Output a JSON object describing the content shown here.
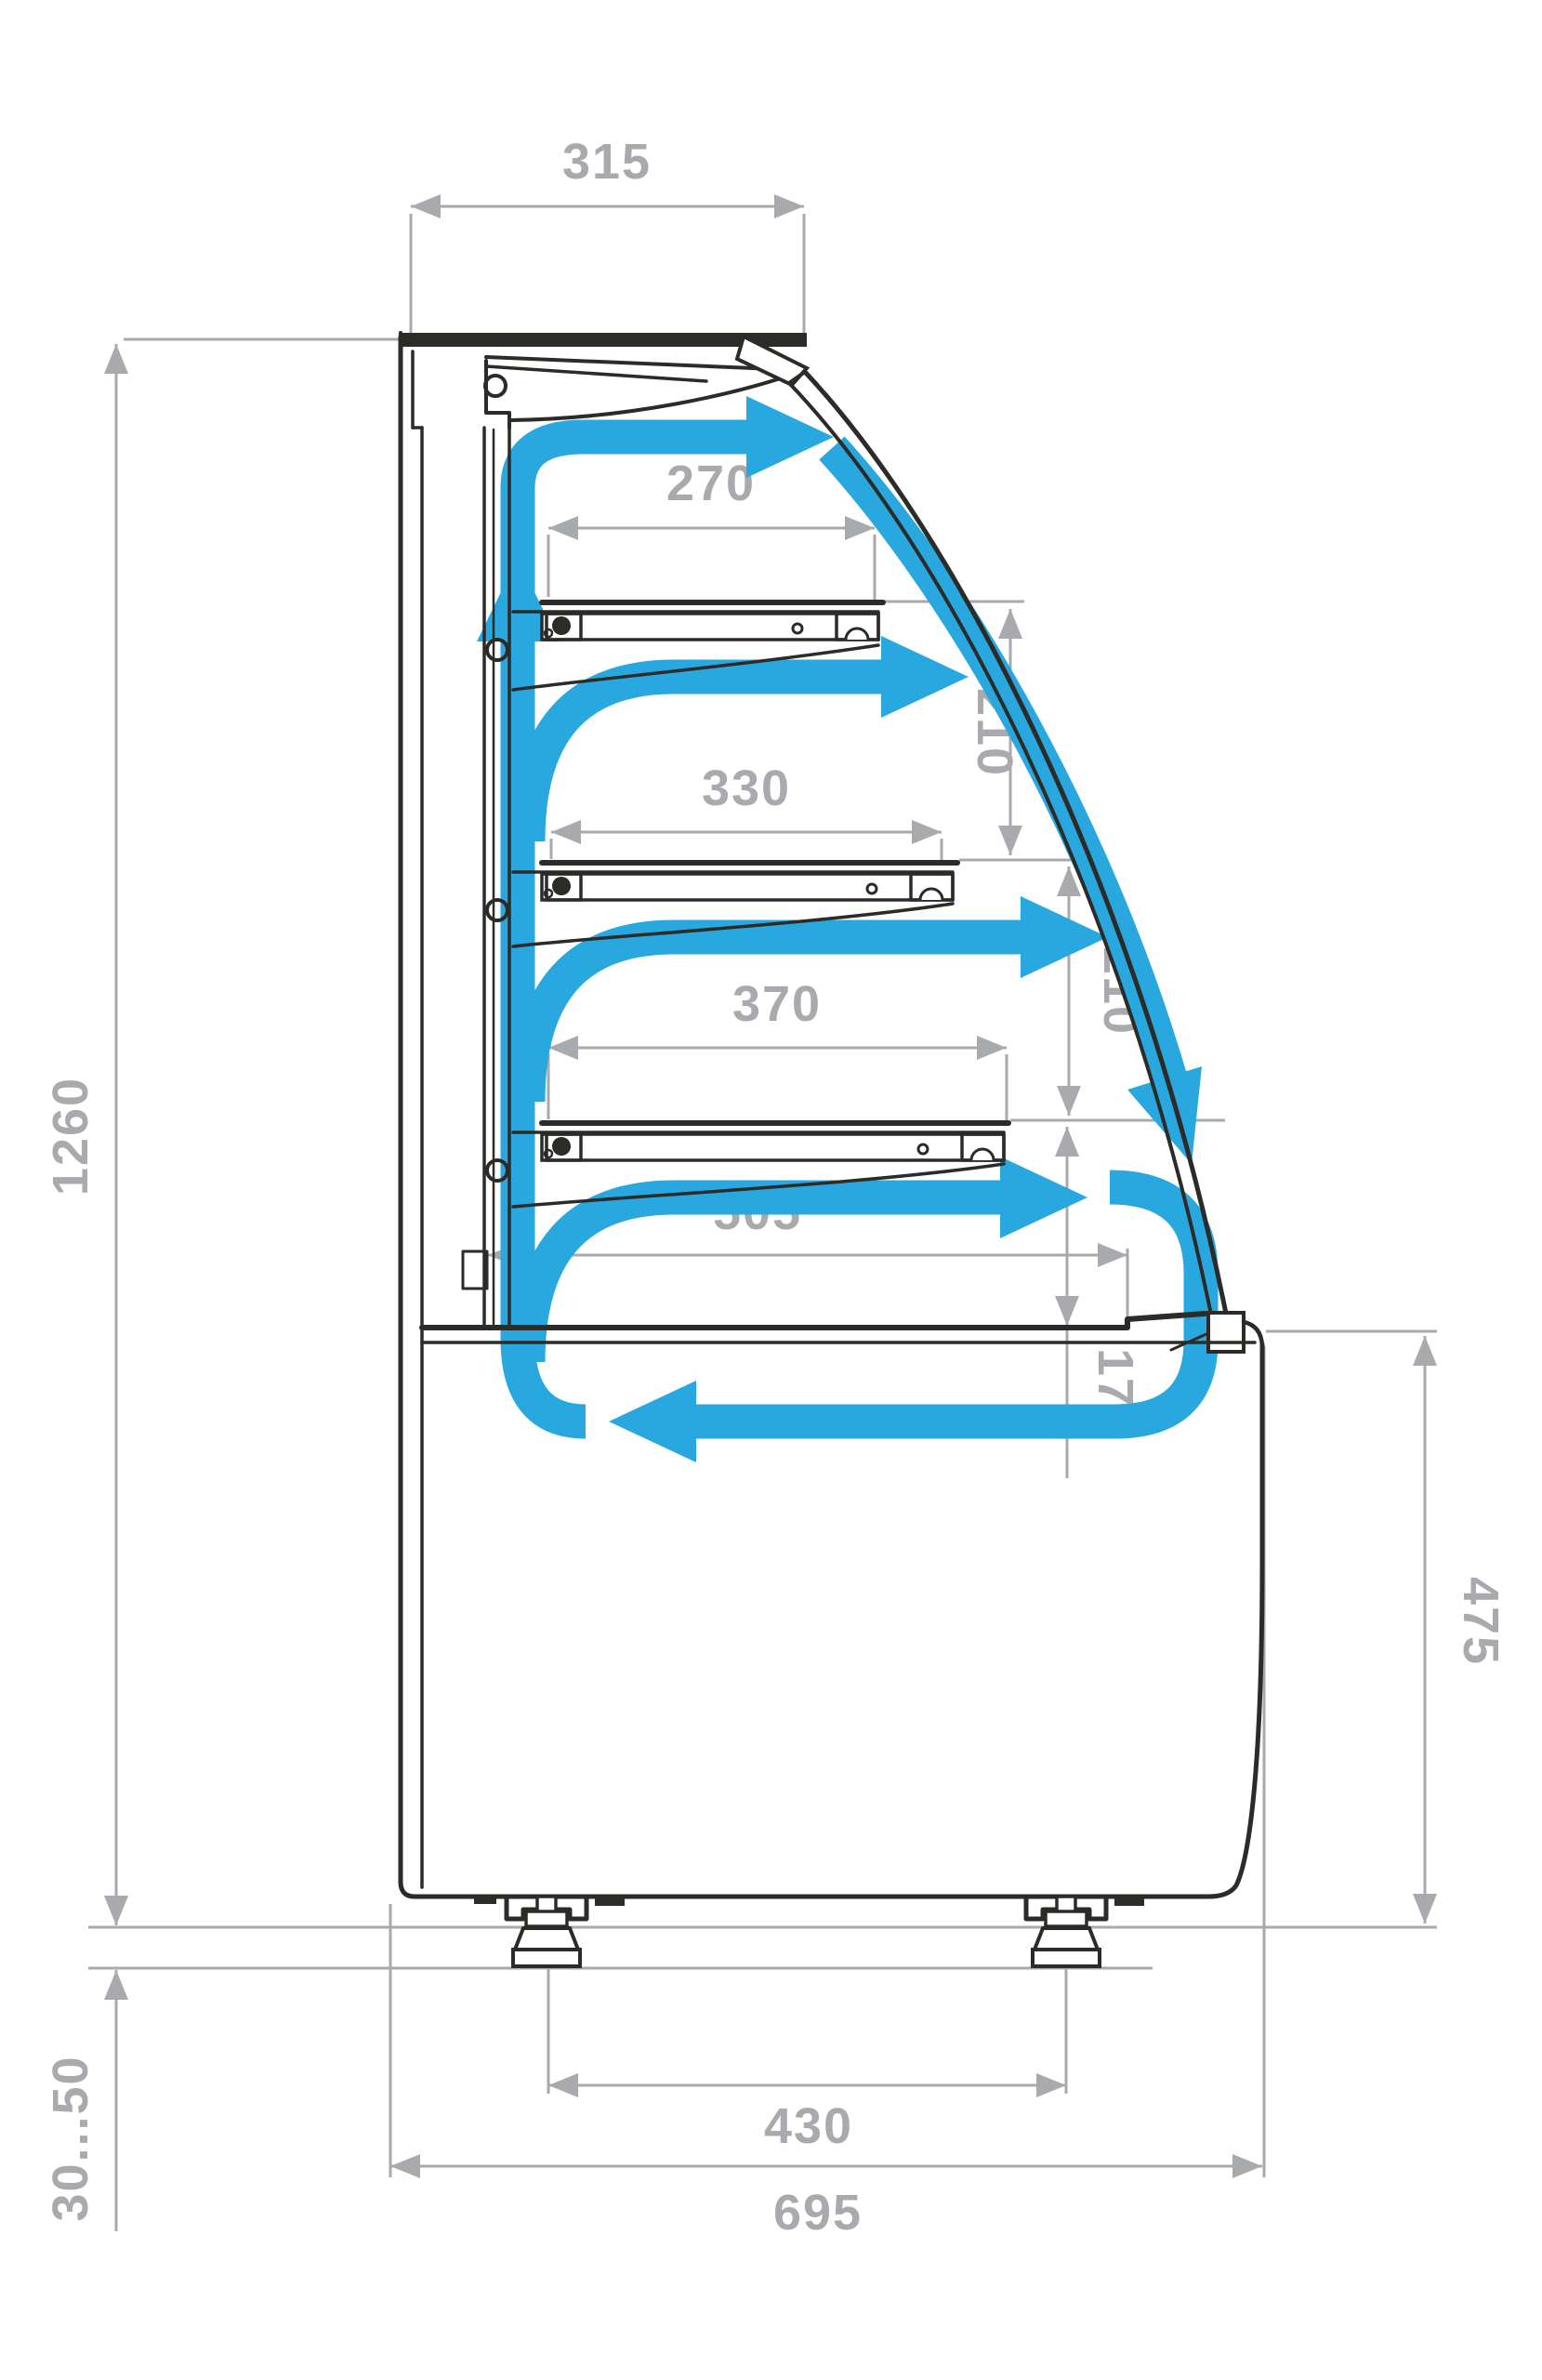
{
  "diagram": {
    "type": "technical-drawing",
    "subject": "curved-glass refrigerated pastry display case - side cross-section with air circulation",
    "colors": {
      "airflow": "#29a8e0",
      "outline": "#2d2b28",
      "dimension": "#a8aaad",
      "background": "#ffffff"
    },
    "dims": {
      "top_depth": "315",
      "shelf1_depth": "270",
      "shelf2_depth": "330",
      "shelf3_depth": "370",
      "deck_depth": "505",
      "gap_shelf1_shelf2": "210",
      "gap_shelf2_shelf3": "210",
      "gap_shelf3_deck": "175",
      "case_height": "1260",
      "base_height": "475",
      "foot_adjust_range": "30...50",
      "feet_spacing": "430",
      "overall_depth": "695"
    },
    "dimension_list": [
      {
        "name": "canopy depth",
        "value": "315"
      },
      {
        "name": "shelf 1 depth",
        "value": "270"
      },
      {
        "name": "shelf 2 depth",
        "value": "330"
      },
      {
        "name": "shelf 3 depth",
        "value": "370"
      },
      {
        "name": "deck depth",
        "value": "505"
      },
      {
        "name": "shelf 1 to shelf 2 gap",
        "value": "210"
      },
      {
        "name": "shelf 2 to shelf 3 gap",
        "value": "210"
      },
      {
        "name": "shelf 3 to deck gap",
        "value": "175"
      },
      {
        "name": "overall height above feet",
        "value": "1260"
      },
      {
        "name": "base section height",
        "value": "475"
      },
      {
        "name": "adjustable foot range",
        "value": "30...50"
      },
      {
        "name": "feet spacing",
        "value": "430"
      },
      {
        "name": "overall depth",
        "value": "695"
      }
    ]
  }
}
